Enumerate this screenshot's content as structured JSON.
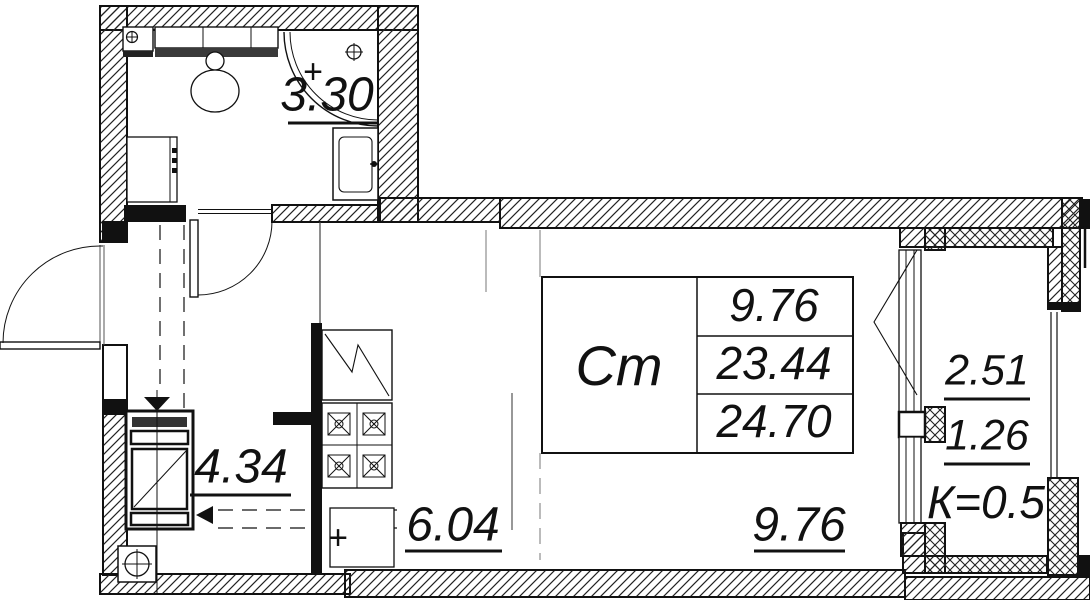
{
  "plan": {
    "bathroom": {
      "area": "3.30"
    },
    "hallway": {
      "area": "4.34"
    },
    "kitchen": {
      "area": "6.04"
    },
    "living": {
      "area": "9.76"
    },
    "balcony": {
      "area_full": "2.51",
      "area_counted": "1.26",
      "coefficient_label": "К=0.5"
    },
    "summary": {
      "type_label": "Ст",
      "living_area": "9.76",
      "apartment_area": "23.44",
      "total_area": "24.70"
    },
    "marks": {
      "bathroom_plus": "+",
      "kitchen_plus": "+"
    },
    "colors": {
      "line": "#111111",
      "background": "#ffffff"
    }
  }
}
